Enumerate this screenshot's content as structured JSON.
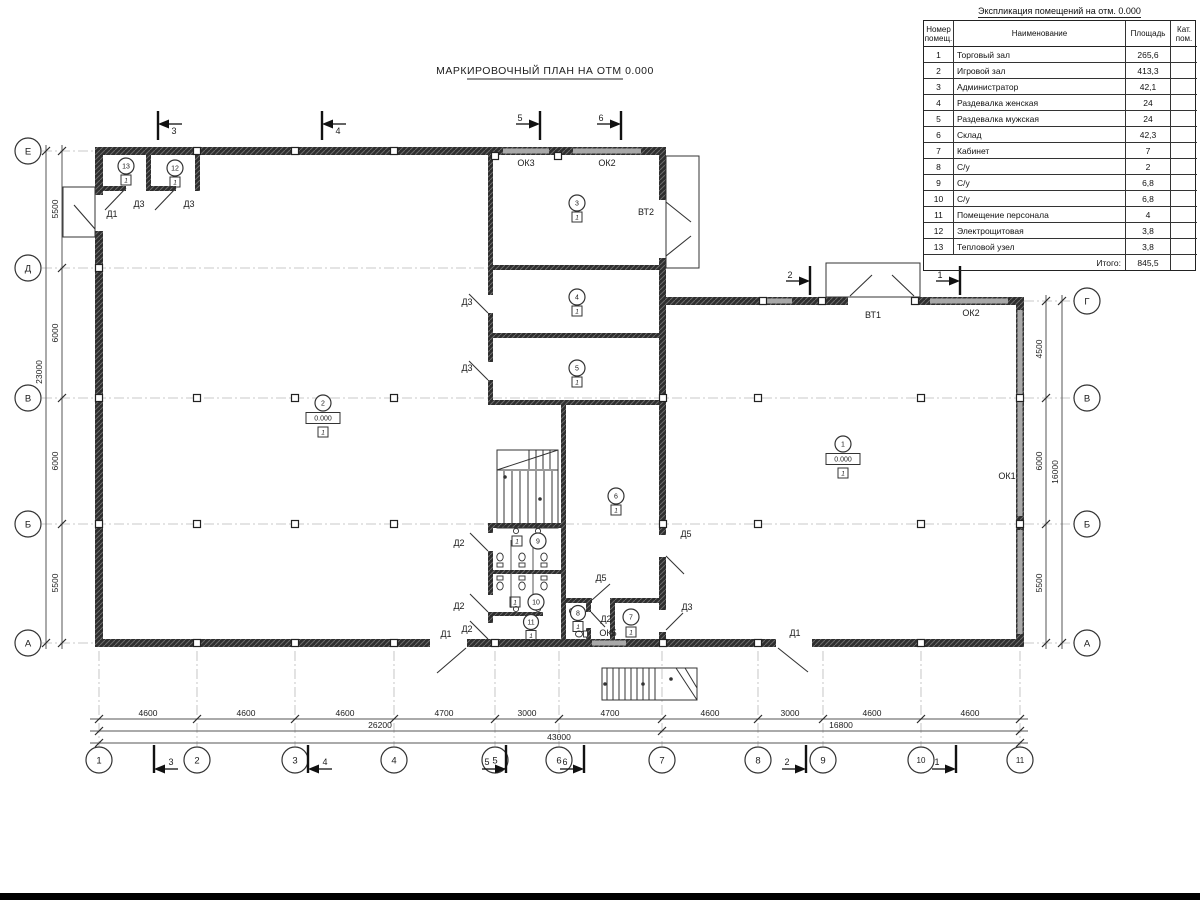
{
  "plan": {
    "title": "МАРКИРОВОЧНЫЙ ПЛАН НА ОТМ 0.000"
  },
  "schedule": {
    "title": "Экспликация помещений на отм. 0.000",
    "headers": {
      "num1": "Номер",
      "num2": "помещ.",
      "name": "Наименование",
      "area": "Площадь",
      "cat1": "Кат.",
      "cat2": "пом."
    },
    "rows": [
      {
        "n": "1",
        "name": "Торговый зал",
        "area": "265,6",
        "cat": ""
      },
      {
        "n": "2",
        "name": "Игровой зал",
        "area": "413,3",
        "cat": ""
      },
      {
        "n": "3",
        "name": "Администратор",
        "area": "42,1",
        "cat": ""
      },
      {
        "n": "4",
        "name": "Раздевалка женская",
        "area": "24",
        "cat": ""
      },
      {
        "n": "5",
        "name": "Раздевалка мужская",
        "area": "24",
        "cat": ""
      },
      {
        "n": "6",
        "name": "Склад",
        "area": "42,3",
        "cat": ""
      },
      {
        "n": "7",
        "name": "Кабинет",
        "area": "7",
        "cat": ""
      },
      {
        "n": "8",
        "name": "С/у",
        "area": "2",
        "cat": ""
      },
      {
        "n": "9",
        "name": "С/у",
        "area": "6,8",
        "cat": ""
      },
      {
        "n": "10",
        "name": "С/у",
        "area": "6,8",
        "cat": ""
      },
      {
        "n": "11",
        "name": "Помещение персонала",
        "area": "4",
        "cat": ""
      },
      {
        "n": "12",
        "name": "Электрощитовая",
        "area": "3,8",
        "cat": ""
      },
      {
        "n": "13",
        "name": "Тепловой узел",
        "area": "3,8",
        "cat": ""
      }
    ],
    "total_label": "Итого:",
    "total_value": "845,5"
  },
  "axes": {
    "bottom": [
      "1",
      "2",
      "3",
      "4",
      "5",
      "6",
      "7",
      "8",
      "9",
      "10",
      "11"
    ],
    "left": [
      "Е",
      "Д",
      "В",
      "Б",
      "А"
    ],
    "right": [
      "Г",
      "В",
      "Б",
      "А"
    ]
  },
  "dims": {
    "bottom": [
      "4600",
      "4600",
      "4600",
      "4700",
      "3000",
      "4700",
      "4600",
      "3000",
      "4600",
      "4600"
    ],
    "bottom_sub": [
      "26200",
      "16800"
    ],
    "bottom_total": "43000",
    "left": [
      "5500",
      "6000",
      "6000",
      "5500"
    ],
    "left_total": "23000",
    "right": [
      "4500",
      "6000",
      "5500"
    ],
    "right_total": "16000"
  },
  "sections": {
    "m1": "1",
    "m2": "2",
    "m3": "3",
    "m4": "4",
    "m5": "5",
    "m6": "6"
  },
  "labels": {
    "d1": "Д1",
    "d2": "Д2",
    "d3": "Д3",
    "d5": "Д5",
    "ok1": "ОК1",
    "ok2": "ОК2",
    "ok3": "ОК3",
    "ok5": "ОК5",
    "vt1": "ВТ1",
    "vt2": "ВТ2",
    "elev": "0.000",
    "floor": "1"
  },
  "room_numbers": [
    "1",
    "2",
    "3",
    "4",
    "5",
    "6",
    "7",
    "8",
    "9",
    "10",
    "11",
    "12",
    "13"
  ]
}
